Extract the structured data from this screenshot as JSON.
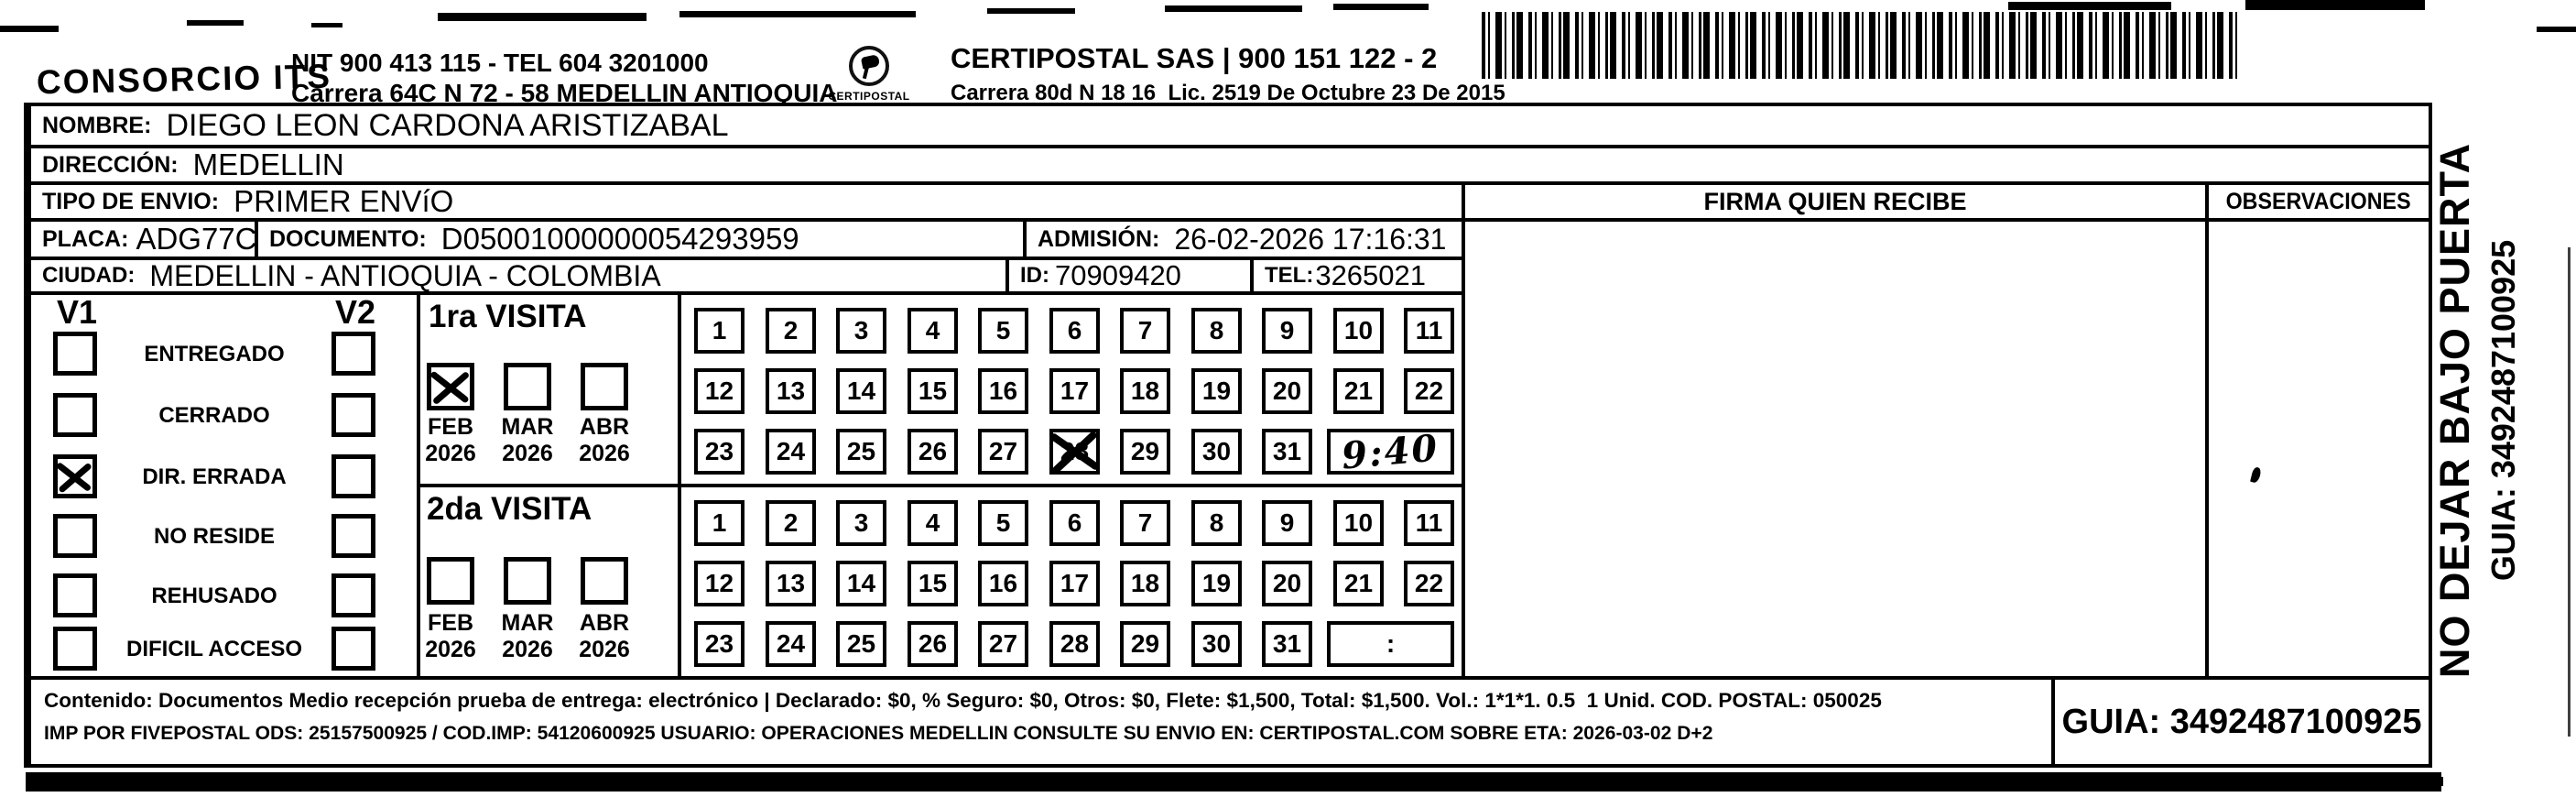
{
  "header": {
    "company": "CONSORCIO ITS",
    "nit_line": "NIT 900 413 115 - TEL 604 3201000",
    "company_address": "Carrera 64C N 72 - 58 MEDELLIN ANTIOQUIA",
    "logo_name": "CERTIPOSTAL",
    "operator_name": "CERTIPOSTAL SAS | 900 151 122 - 2",
    "operator_address": "Carrera 80d N 18 16  Lic. 2519 De Octubre 23 De 2015"
  },
  "fields": {
    "nombre_label": "NOMBRE:",
    "nombre_value": "DIEGO LEON CARDONA ARISTIZABAL",
    "direccion_label": "DIRECCIÓN:",
    "direccion_value": "MEDELLIN",
    "tipo_envio_label": "TIPO DE ENVIO:",
    "tipo_envio_value": "PRIMER ENVíO",
    "placa_label": "PLACA:",
    "placa_value": "ADG77C",
    "documento_label": "DOCUMENTO:",
    "documento_value": "D05001000000054293959",
    "admision_label": "ADMISIÓN:",
    "admision_value": "26-02-2026 17:16:31",
    "ciudad_label": "CIUDAD:",
    "ciudad_value": "MEDELLIN - ANTIOQUIA - COLOMBIA",
    "id_label": "ID:",
    "id_value": "70909420",
    "tel_label": "TEL:",
    "tel_value": "3265021"
  },
  "signature_section": {
    "firma_header": "FIRMA QUIEN RECIBE",
    "observaciones_header": "OBSERVACIONES"
  },
  "status_panel": {
    "v1_header": "V1",
    "v2_header": "V2",
    "items": [
      {
        "label": "ENTREGADO",
        "v1_checked": false,
        "v2_checked": false
      },
      {
        "label": "CERRADO",
        "v1_checked": false,
        "v2_checked": false
      },
      {
        "label": "DIR. ERRADA",
        "v1_checked": true,
        "v2_checked": false
      },
      {
        "label": "NO RESIDE",
        "v1_checked": false,
        "v2_checked": false
      },
      {
        "label": "REHUSADO",
        "v1_checked": false,
        "v2_checked": false
      },
      {
        "label": "DIFICIL ACCESO",
        "v1_checked": false,
        "v2_checked": false
      }
    ]
  },
  "day_grid_rows": [
    [
      1,
      2,
      3,
      4,
      5,
      6,
      7,
      8,
      9,
      10,
      11
    ],
    [
      12,
      13,
      14,
      15,
      16,
      17,
      18,
      19,
      20,
      21,
      22
    ],
    [
      23,
      24,
      25,
      26,
      27,
      28,
      29,
      30,
      31
    ]
  ],
  "visits": [
    {
      "title": "1ra VISITA",
      "months": [
        {
          "month": "FEB",
          "year": "2026",
          "checked": true
        },
        {
          "month": "MAR",
          "year": "2026",
          "checked": false
        },
        {
          "month": "ABR",
          "year": "2026",
          "checked": false
        }
      ],
      "crossed_day": 28,
      "time_value": "9:40",
      "time_handwritten": true
    },
    {
      "title": "2da VISITA",
      "months": [
        {
          "month": "FEB",
          "year": "2026",
          "checked": false
        },
        {
          "month": "MAR",
          "year": "2026",
          "checked": false
        },
        {
          "month": "ABR",
          "year": "2026",
          "checked": false
        }
      ],
      "crossed_day": null,
      "time_value": ":",
      "time_handwritten": false
    }
  ],
  "footer": {
    "line1": "Contenido: Documentos Medio recepción prueba de entrega: electrónico | Declarado: $0, % Seguro: $0, Otros: $0, Flete: $1,500, Total: $1,500. Vol.: 1*1*1. 0.5  1 Unid. COD. POSTAL: 050025",
    "line2": "IMP POR FIVEPOSTAL ODS: 25157500925 / COD.IMP: 54120600925 USUARIO: OPERACIONES MEDELLIN CONSULTE SU ENVIO EN: CERTIPOSTAL.COM SOBRE ETA: 2026-03-02 D+2",
    "guia_label": "GUIA: 3492487100925"
  },
  "side_note": {
    "line1": "NO DEJAR BAJO PUERTA",
    "line2": "GUIA: 3492487100925"
  }
}
